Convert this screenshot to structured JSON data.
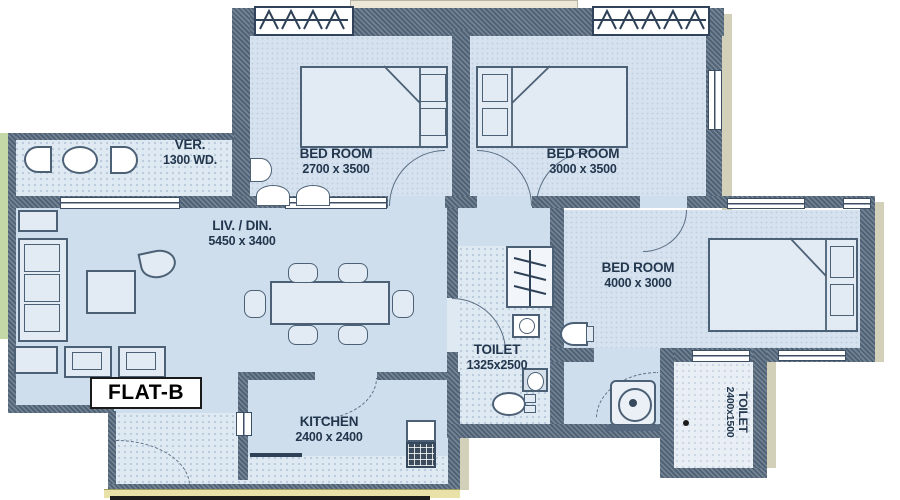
{
  "plan": {
    "flat_label": "FLAT-B",
    "rooms": [
      {
        "key": "verandah",
        "name": "VER.",
        "dims": "1300 WD."
      },
      {
        "key": "bedroom-1",
        "name": "BED ROOM",
        "dims": "2700 x 3500"
      },
      {
        "key": "bedroom-2",
        "name": "BED ROOM",
        "dims": "3000 x 3500"
      },
      {
        "key": "bedroom-3",
        "name": "BED ROOM",
        "dims": "4000 x 3000"
      },
      {
        "key": "living-dining",
        "name": "LIV. / DIN.",
        "dims": "5450 x 3400"
      },
      {
        "key": "kitchen",
        "name": "KITCHEN",
        "dims": "2400 x 2400"
      },
      {
        "key": "toilet-1",
        "name": "TOILET",
        "dims": "1325x2500"
      },
      {
        "key": "toilet-2",
        "name": "TOILET",
        "dims": "2400x1500"
      }
    ],
    "icons": {
      "bed-icon": "rect with fold line and pillows",
      "sofa-icon": "rect with cushions",
      "dining-table-icon": "rect with 6 chairs",
      "shower-icon": "panel with zigzag",
      "wc-icon": "box with oval",
      "wash-basin-icon": "oval / half-round",
      "washing-machine-icon": "circle in box",
      "kitchen-sink-icon": "grid box",
      "door-swing-icon": "quarter arc",
      "window-icon": "double line sill",
      "casement-window-icon": "zigzag marks"
    },
    "colors": {
      "floor": "#cedeed",
      "hatch_floor": "#dfe9f2",
      "wall": "#56697e",
      "garden_green": "#c4d7a6",
      "ledge_beige": "#ece7d7",
      "sill_yellow": "#e9e2a8",
      "label_text": "#22364d"
    }
  }
}
